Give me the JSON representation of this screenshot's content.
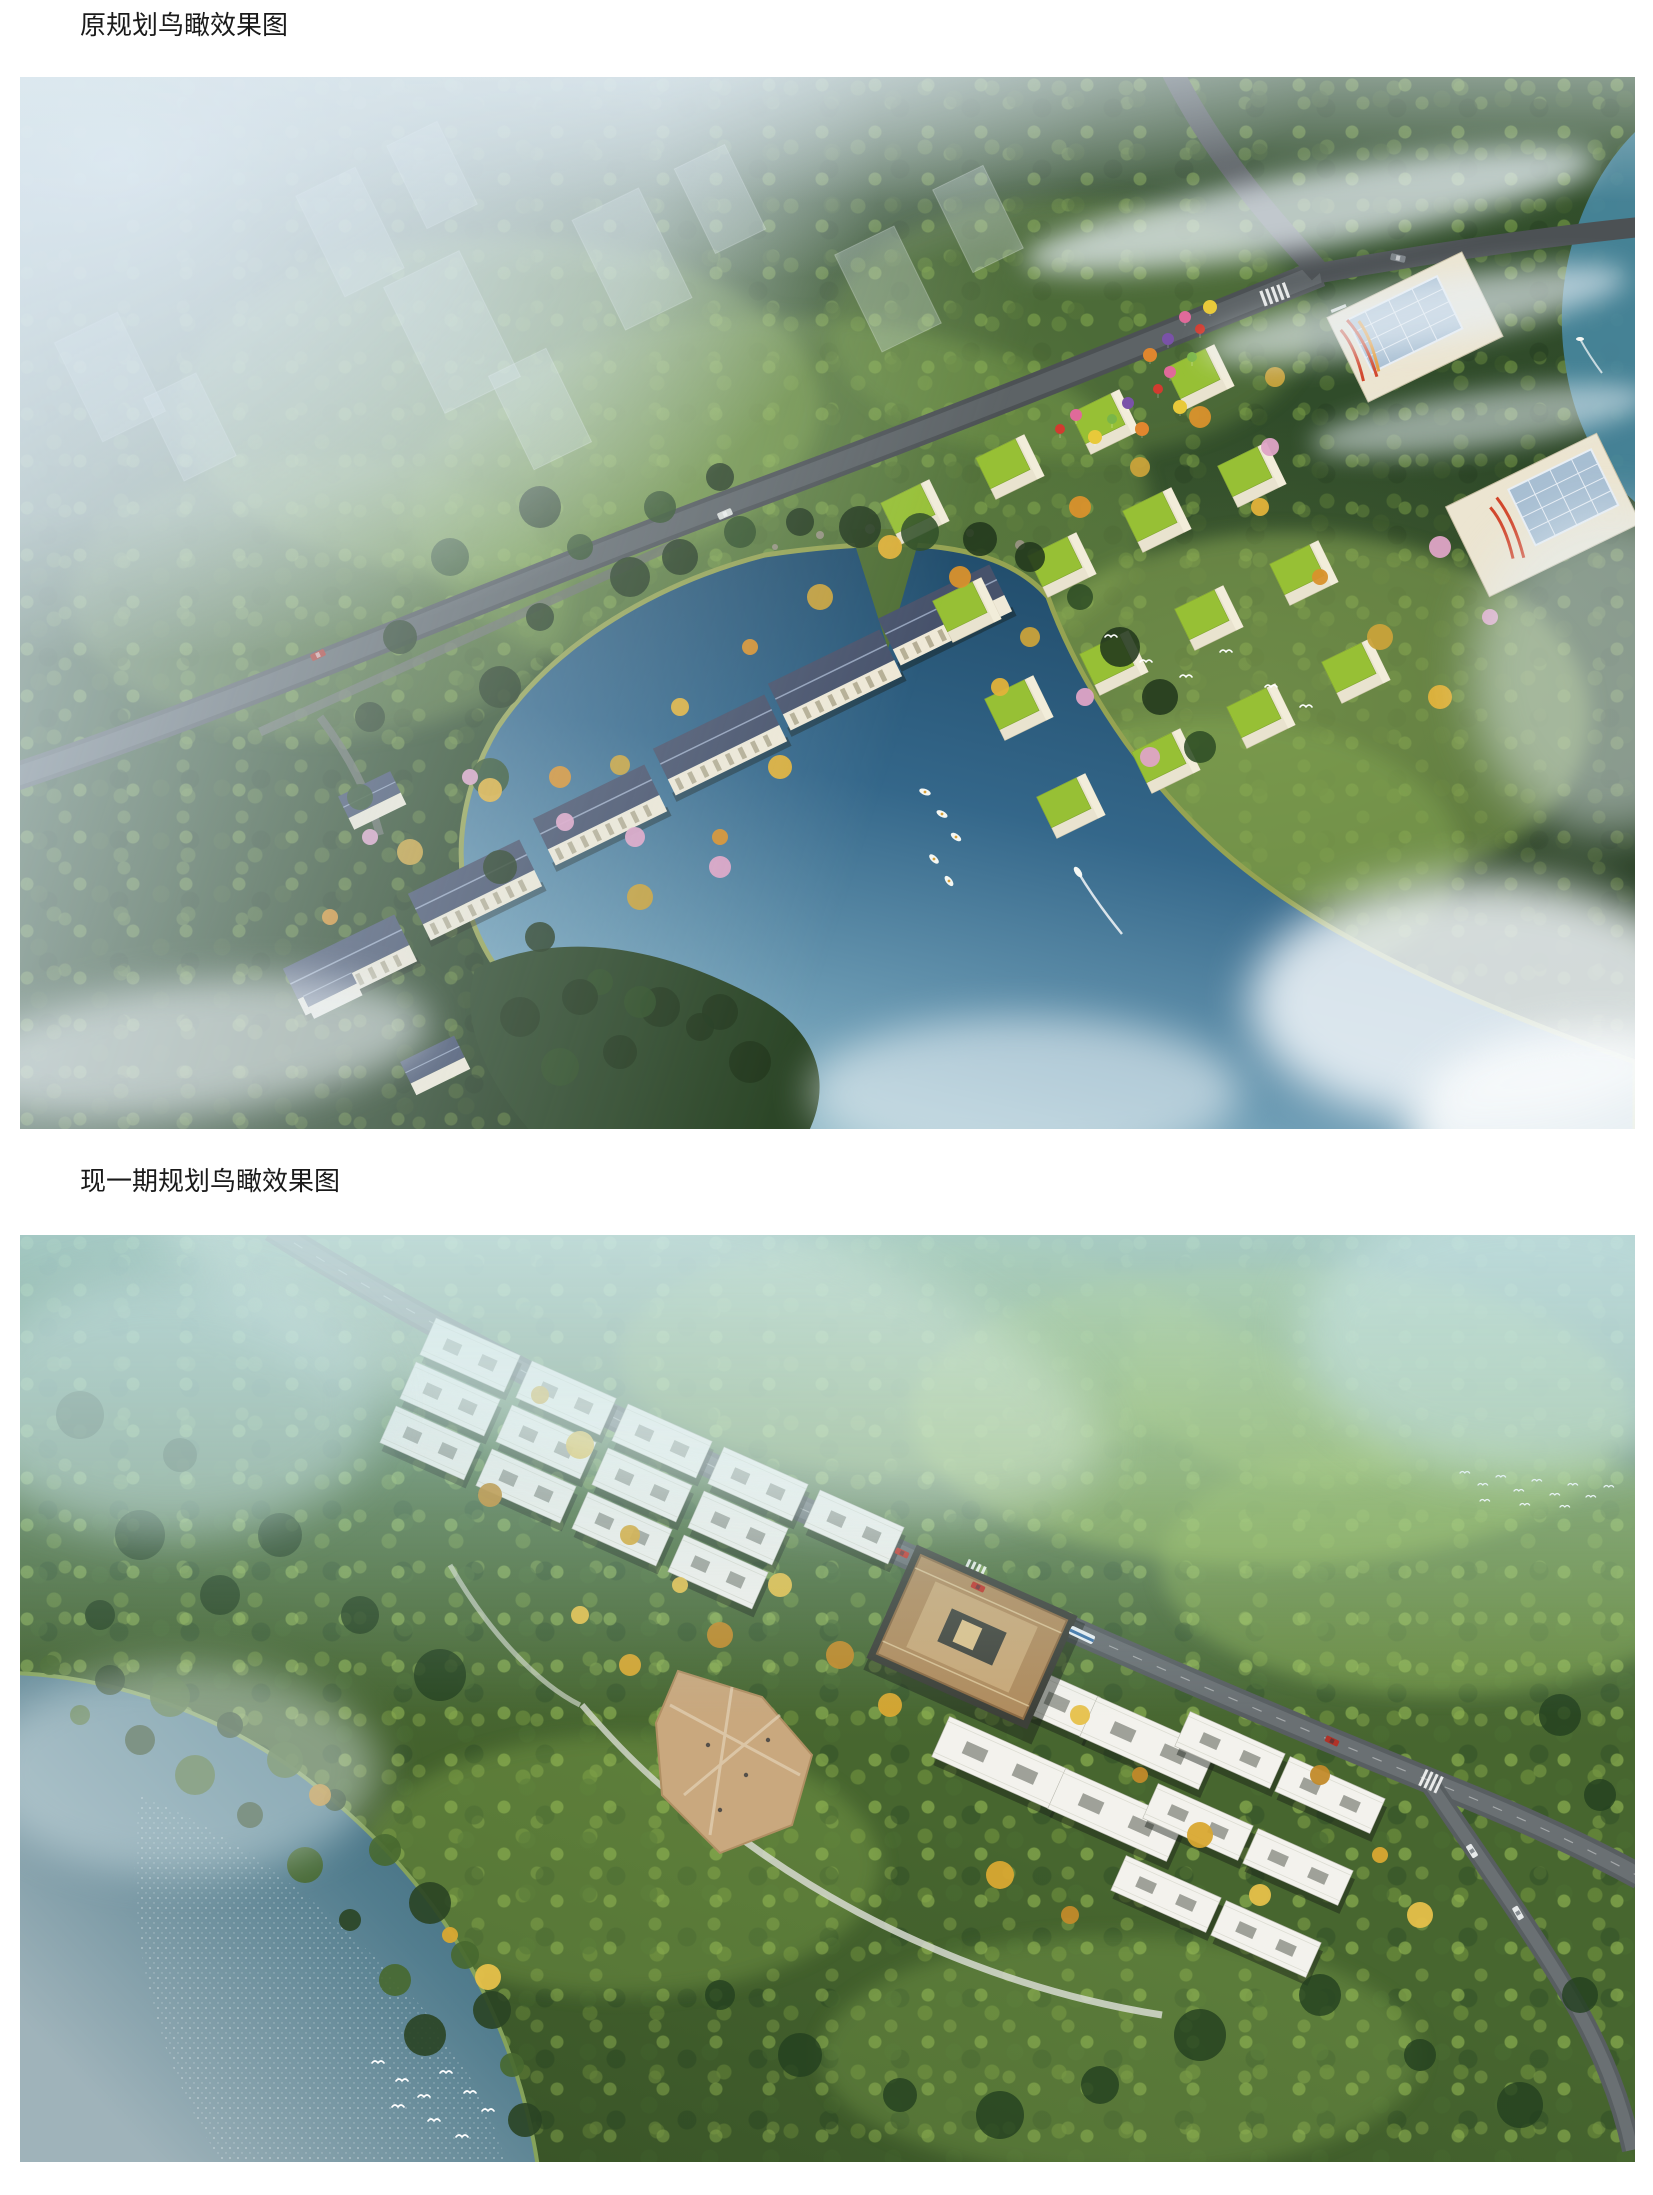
{
  "document": {
    "figures": [
      {
        "caption": "原规划鸟瞰效果图",
        "scene": "aerial rendering of the original master plan",
        "features": [
          "morning fog with faint city towers",
          "dense forest",
          "slab apartment row along curved road",
          "green-roof townhouse grid with celebration balloons",
          "two large amenity buildings with glass roofs",
          "lake with small boats and a speedboat wake",
          "road intersection with crosswalks",
          "white egrets"
        ]
      },
      {
        "caption": "现一期规划鸟瞰效果图",
        "scene": "aerial rendering of the current phase-one plan",
        "features": [
          "hazy teal forest",
          "stepped rows of white flat-roof townhouses along main road",
          "bronze clubhouse with inner courtyard",
          "paved landscape plaza",
          "branch road with cars and bus",
          "grey-blue lake with sun sparkle",
          "white egrets over water"
        ]
      }
    ]
  },
  "palette": {
    "page_bg": "#ffffff",
    "text": "#1a1a1a",
    "forest_green": "#33502c",
    "forest_green_light": "#47662f",
    "meadow_green": "#8fb457",
    "lake_blue_deep": "#1d4765",
    "lake_blue_light": "#9fc4cf",
    "water_grey_blue": "#527d8e",
    "fog_white": "#dde9f2",
    "building_wall": "#ece5d1",
    "building_white": "#f3f2ed",
    "roof_slate": "#47526b",
    "roof_grass_green": "#97c035",
    "clubhouse_bronze": "#b08c5e",
    "plaza_tan": "#c9a87e",
    "road_grey": "#53585b",
    "autumn_orange": "#d9912c",
    "blossom_pink": "#dea4c6",
    "balloon_red": "#d23b2f"
  }
}
